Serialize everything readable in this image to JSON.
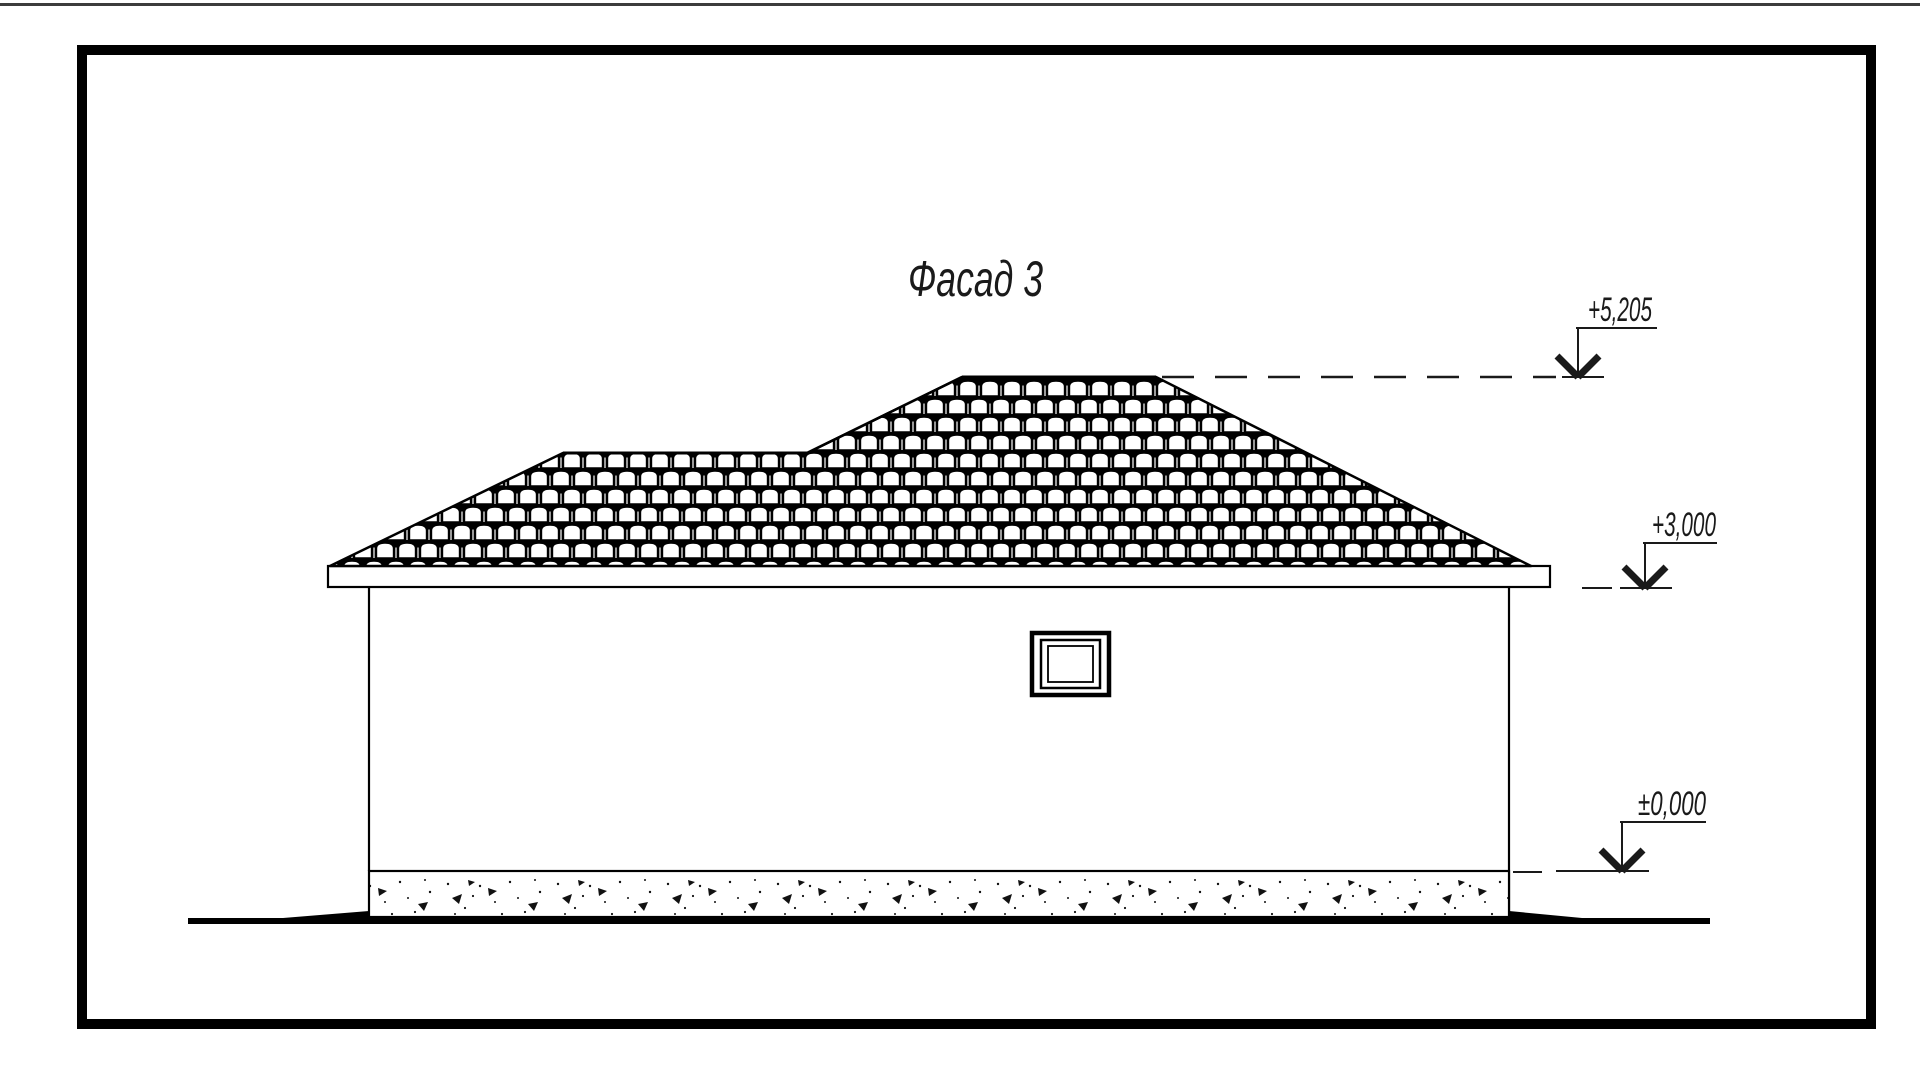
{
  "page": {
    "background": "#ffffff",
    "top_rule_color": "#3c3c3c"
  },
  "frame": {
    "border_color": "#000000"
  },
  "drawing": {
    "title": "Фасад 3",
    "ink_color": "#000000",
    "elevation_marks": [
      {
        "id": "ridge-level",
        "value": "+5,205"
      },
      {
        "id": "eaves-level",
        "value": "+3,000"
      },
      {
        "id": "ground-level",
        "value": "±0,000"
      }
    ]
  }
}
